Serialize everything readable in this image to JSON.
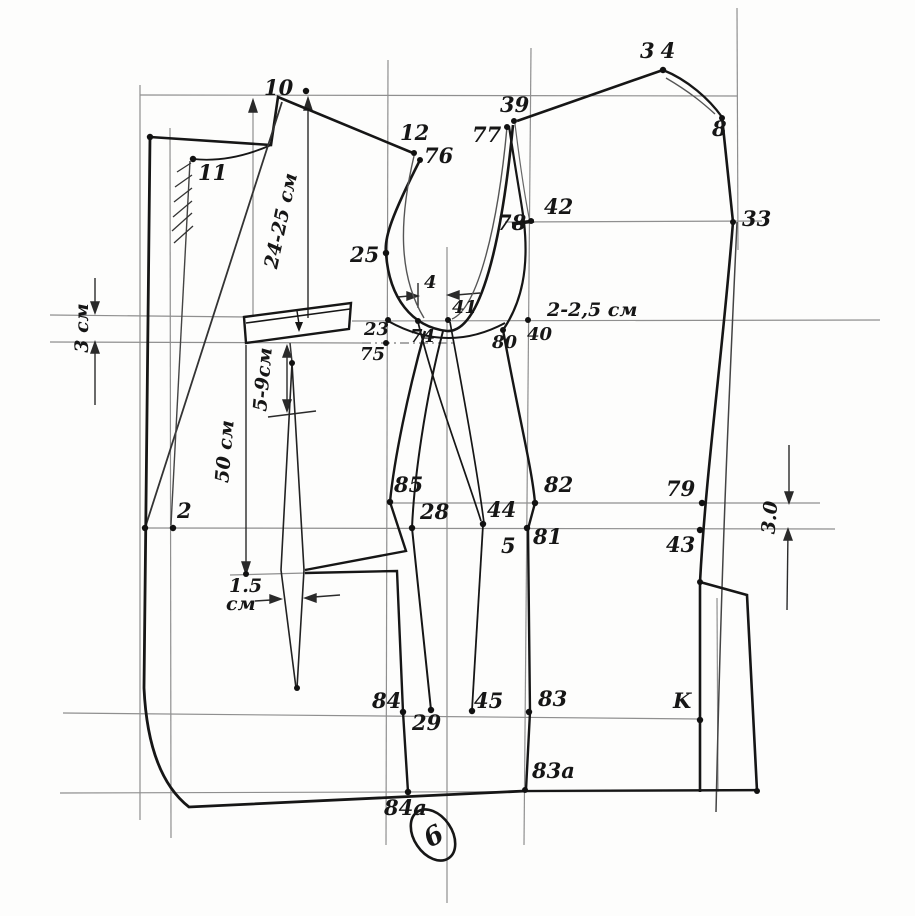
{
  "figure": {
    "kind": "hand-drawn jacket pattern drafting diagram",
    "sheet_number": "6",
    "ink_color": "#161616",
    "pencil_color": "#8f8f8f",
    "paper_color": "#fdfdfc"
  },
  "points": {
    "p2": "2",
    "p4": "4",
    "p5": "5",
    "p8": "8",
    "p10": "10",
    "p11": "11",
    "p12": "12",
    "p23": "23",
    "p25": "25",
    "p28": "28",
    "p29": "29",
    "p33": "33",
    "p34": "34",
    "p39": "39",
    "p40": "40",
    "p41": "41",
    "p42": "42",
    "p43": "43",
    "p44": "44",
    "p45": "45",
    "p74": "74",
    "p75": "75",
    "p76": "76",
    "p77": "77",
    "p78": "78",
    "p79": "79",
    "p80": "80",
    "p81": "81",
    "p82": "82",
    "p83": "83",
    "p83a": "83a",
    "p84": "84",
    "p84a": "84a",
    "p85": "85",
    "pK": "K"
  },
  "dimensions": {
    "d24_25": "24-25 см",
    "d50": "50 см",
    "d5_9": "5-9см",
    "d3": "3 см",
    "d2_25": "2-2,5 см",
    "d1_5_value": "1.5",
    "d1_5_unit": "см",
    "d3_0": "3.0"
  }
}
